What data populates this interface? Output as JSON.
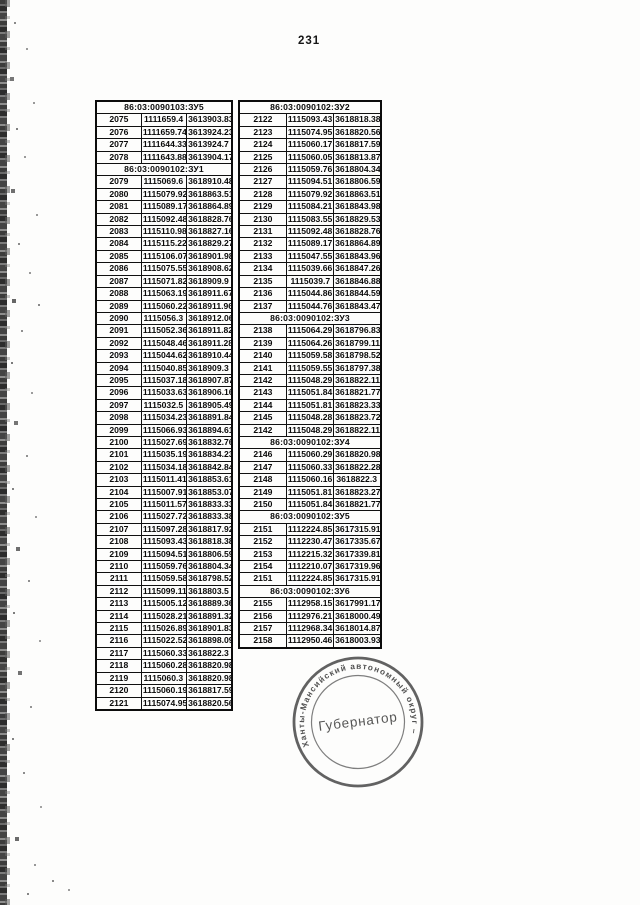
{
  "page": {
    "number": "231",
    "background": "#fdfdfc",
    "ink": "#0a0a0a",
    "stamp_ink": "#3f3f3f"
  },
  "left_table": {
    "sections": [
      {
        "header": "86:03:0090103:ЗУ5",
        "rows": [
          [
            "2075",
            "1111659.4",
            "3613903.83"
          ],
          [
            "2076",
            "1111659.74",
            "3613924.23"
          ],
          [
            "2077",
            "1111644.33",
            "3613924.7"
          ],
          [
            "2078",
            "1111643.88",
            "3613904.17"
          ]
        ]
      },
      {
        "header": "86:03:0090102:ЗУ1",
        "rows": [
          [
            "2079",
            "1115069.6",
            "3618910.48"
          ],
          [
            "2080",
            "1115079.92",
            "3618863.51"
          ],
          [
            "2081",
            "1115089.17",
            "3618864.89"
          ],
          [
            "2082",
            "1115092.48",
            "3618828.76"
          ],
          [
            "2083",
            "1115110.98",
            "3618827.16"
          ],
          [
            "2084",
            "1115115.22",
            "3618829.27"
          ],
          [
            "2085",
            "1115106.07",
            "3618901.98"
          ],
          [
            "2086",
            "1115075.55",
            "3618908.62"
          ],
          [
            "2087",
            "1115071.82",
            "3618909.9"
          ],
          [
            "2088",
            "1115063.19",
            "3618911.67"
          ],
          [
            "2089",
            "1115060.22",
            "3618911.96"
          ],
          [
            "2090",
            "1115056.3",
            "3618912.06"
          ],
          [
            "2091",
            "1115052.36",
            "3618911.82"
          ],
          [
            "2092",
            "1115048.46",
            "3618911.28"
          ],
          [
            "2093",
            "1115044.62",
            "3618910.44"
          ],
          [
            "2094",
            "1115040.85",
            "3618909.3"
          ],
          [
            "2095",
            "1115037.18",
            "3618907.87"
          ],
          [
            "2096",
            "1115033.63",
            "3618906.16"
          ],
          [
            "2097",
            "1115032.5",
            "3618905.49"
          ],
          [
            "2098",
            "1115034.23",
            "3618891.84"
          ],
          [
            "2099",
            "1115066.93",
            "3618894.61"
          ],
          [
            "2100",
            "1115027.69",
            "3618832.76"
          ],
          [
            "2101",
            "1115035.19",
            "3618834.23"
          ],
          [
            "2102",
            "1115034.18",
            "3618842.84"
          ],
          [
            "2103",
            "1115011.41",
            "3618853.61"
          ],
          [
            "2104",
            "1115007.91",
            "3618853.07"
          ],
          [
            "2105",
            "1115011.57",
            "3618833.33"
          ],
          [
            "2106",
            "1115027.72",
            "3618833.38"
          ],
          [
            "2107",
            "1115097.28",
            "3618817.92"
          ],
          [
            "2108",
            "1115093.43",
            "3618818.38"
          ],
          [
            "2109",
            "1115094.51",
            "3618806.59"
          ],
          [
            "2110",
            "1115059.76",
            "3618804.34"
          ],
          [
            "2111",
            "1115059.58",
            "3618798.52"
          ],
          [
            "2112",
            "1115099.11",
            "3618803.5"
          ],
          [
            "2113",
            "1115005.12",
            "3618889.36"
          ],
          [
            "2114",
            "1115028.21",
            "3618891.32"
          ],
          [
            "2115",
            "1115026.89",
            "3618901.83"
          ],
          [
            "2116",
            "1115022.52",
            "3618898.09"
          ],
          [
            "2117",
            "1115060.33",
            "3618822.3"
          ],
          [
            "2118",
            "1115060.28",
            "3618820.98"
          ],
          [
            "2119",
            "1115060.3",
            "3618820.98"
          ],
          [
            "2120",
            "1115060.19",
            "3618817.59"
          ],
          [
            "2121",
            "1115074.95",
            "3618820.56"
          ]
        ]
      }
    ]
  },
  "right_table": {
    "sections": [
      {
        "header": "86:03:0090102:ЗУ2",
        "rows": [
          [
            "2122",
            "1115093.43",
            "3618818.38"
          ],
          [
            "2123",
            "1115074.95",
            "3618820.56"
          ],
          [
            "2124",
            "1115060.17",
            "3618817.59"
          ],
          [
            "2125",
            "1115060.05",
            "3618813.87"
          ],
          [
            "2126",
            "1115059.76",
            "3618804.34"
          ],
          [
            "2127",
            "1115094.51",
            "3618806.59"
          ],
          [
            "2128",
            "1115079.92",
            "3618863.51"
          ],
          [
            "2129",
            "1115084.21",
            "3618843.98"
          ],
          [
            "2130",
            "1115083.55",
            "3618829.53"
          ],
          [
            "2131",
            "1115092.48",
            "3618828.76"
          ],
          [
            "2132",
            "1115089.17",
            "3618864.89"
          ],
          [
            "2133",
            "1115047.55",
            "3618843.96"
          ],
          [
            "2134",
            "1115039.66",
            "3618847.26"
          ],
          [
            "2135",
            "1115039.7",
            "3618846.88"
          ],
          [
            "2136",
            "1115044.86",
            "3618844.59"
          ],
          [
            "2137",
            "1115044.76",
            "3618843.47"
          ]
        ]
      },
      {
        "header": "86:03:0090102:ЗУ3",
        "rows": [
          [
            "2138",
            "1115064.29",
            "3618796.83"
          ],
          [
            "2139",
            "1115064.26",
            "3618799.11"
          ],
          [
            "2140",
            "1115059.58",
            "3618798.52"
          ],
          [
            "2141",
            "1115059.55",
            "3618797.38"
          ],
          [
            "2142",
            "1115048.29",
            "3618822.11"
          ],
          [
            "2143",
            "1115051.84",
            "3618821.77"
          ],
          [
            "2144",
            "1115051.81",
            "3618823.33"
          ],
          [
            "2145",
            "1115048.28",
            "3618823.72"
          ],
          [
            "2142",
            "1115048.29",
            "3618822.11"
          ]
        ]
      },
      {
        "header": "86:03:0090102:ЗУ4",
        "rows": [
          [
            "2146",
            "1115060.29",
            "3618820.98"
          ],
          [
            "2147",
            "1115060.33",
            "3618822.28"
          ],
          [
            "2148",
            "1115060.16",
            "3618822.3"
          ],
          [
            "2149",
            "1115051.81",
            "3618823.27"
          ],
          [
            "2150",
            "1115051.84",
            "3618821.77"
          ]
        ]
      },
      {
        "header": "86:03:0090102:ЗУ5",
        "rows": [
          [
            "2151",
            "1112224.85",
            "3617315.91"
          ],
          [
            "2152",
            "1112230.47",
            "3617335.67"
          ],
          [
            "2153",
            "1112215.32",
            "3617339.81"
          ],
          [
            "2154",
            "1112210.07",
            "3617319.96"
          ],
          [
            "2151",
            "1112224.85",
            "3617315.91"
          ]
        ]
      },
      {
        "header": "86:03:0090102:ЗУ6",
        "rows": [
          [
            "2155",
            "1112958.15",
            "3617991.17"
          ],
          [
            "2156",
            "1112976.21",
            "3618000.49"
          ],
          [
            "2157",
            "1112968.34",
            "3618014.87"
          ],
          [
            "2158",
            "1112950.46",
            "3618003.93"
          ]
        ]
      }
    ]
  },
  "stamp": {
    "ring_text": "Ханты-Мансийский автономный округ – Югра",
    "center_text": "Губернатор"
  }
}
